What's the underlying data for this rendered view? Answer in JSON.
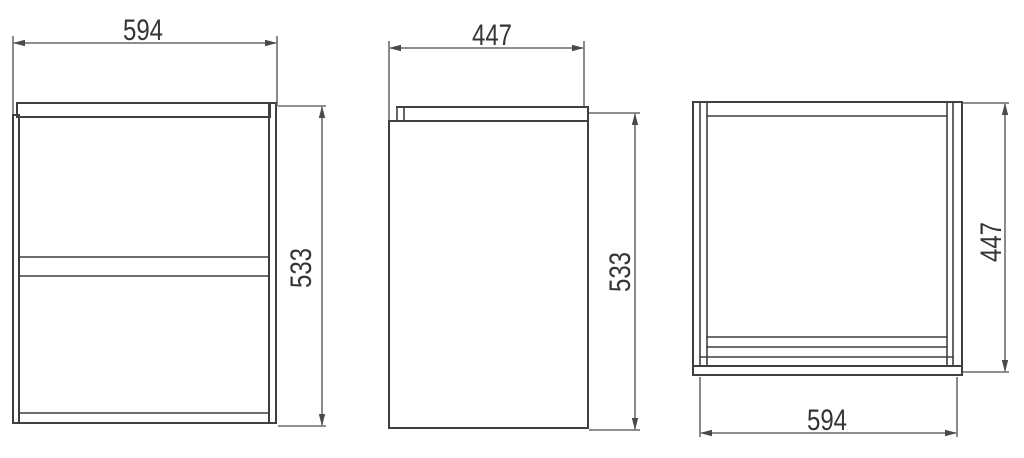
{
  "drawing_type": "cabinet-orthographic-views",
  "views": {
    "front": {
      "width_dim": "594",
      "height_dim": "533"
    },
    "side": {
      "depth_dim": "447",
      "height_dim": "533"
    },
    "top": {
      "depth_dim": "447",
      "width_dim": "594"
    }
  },
  "colors": {
    "line": "#3f3f3f",
    "dimension": "#4a4a4a",
    "text": "#353535",
    "background": "#ffffff"
  }
}
